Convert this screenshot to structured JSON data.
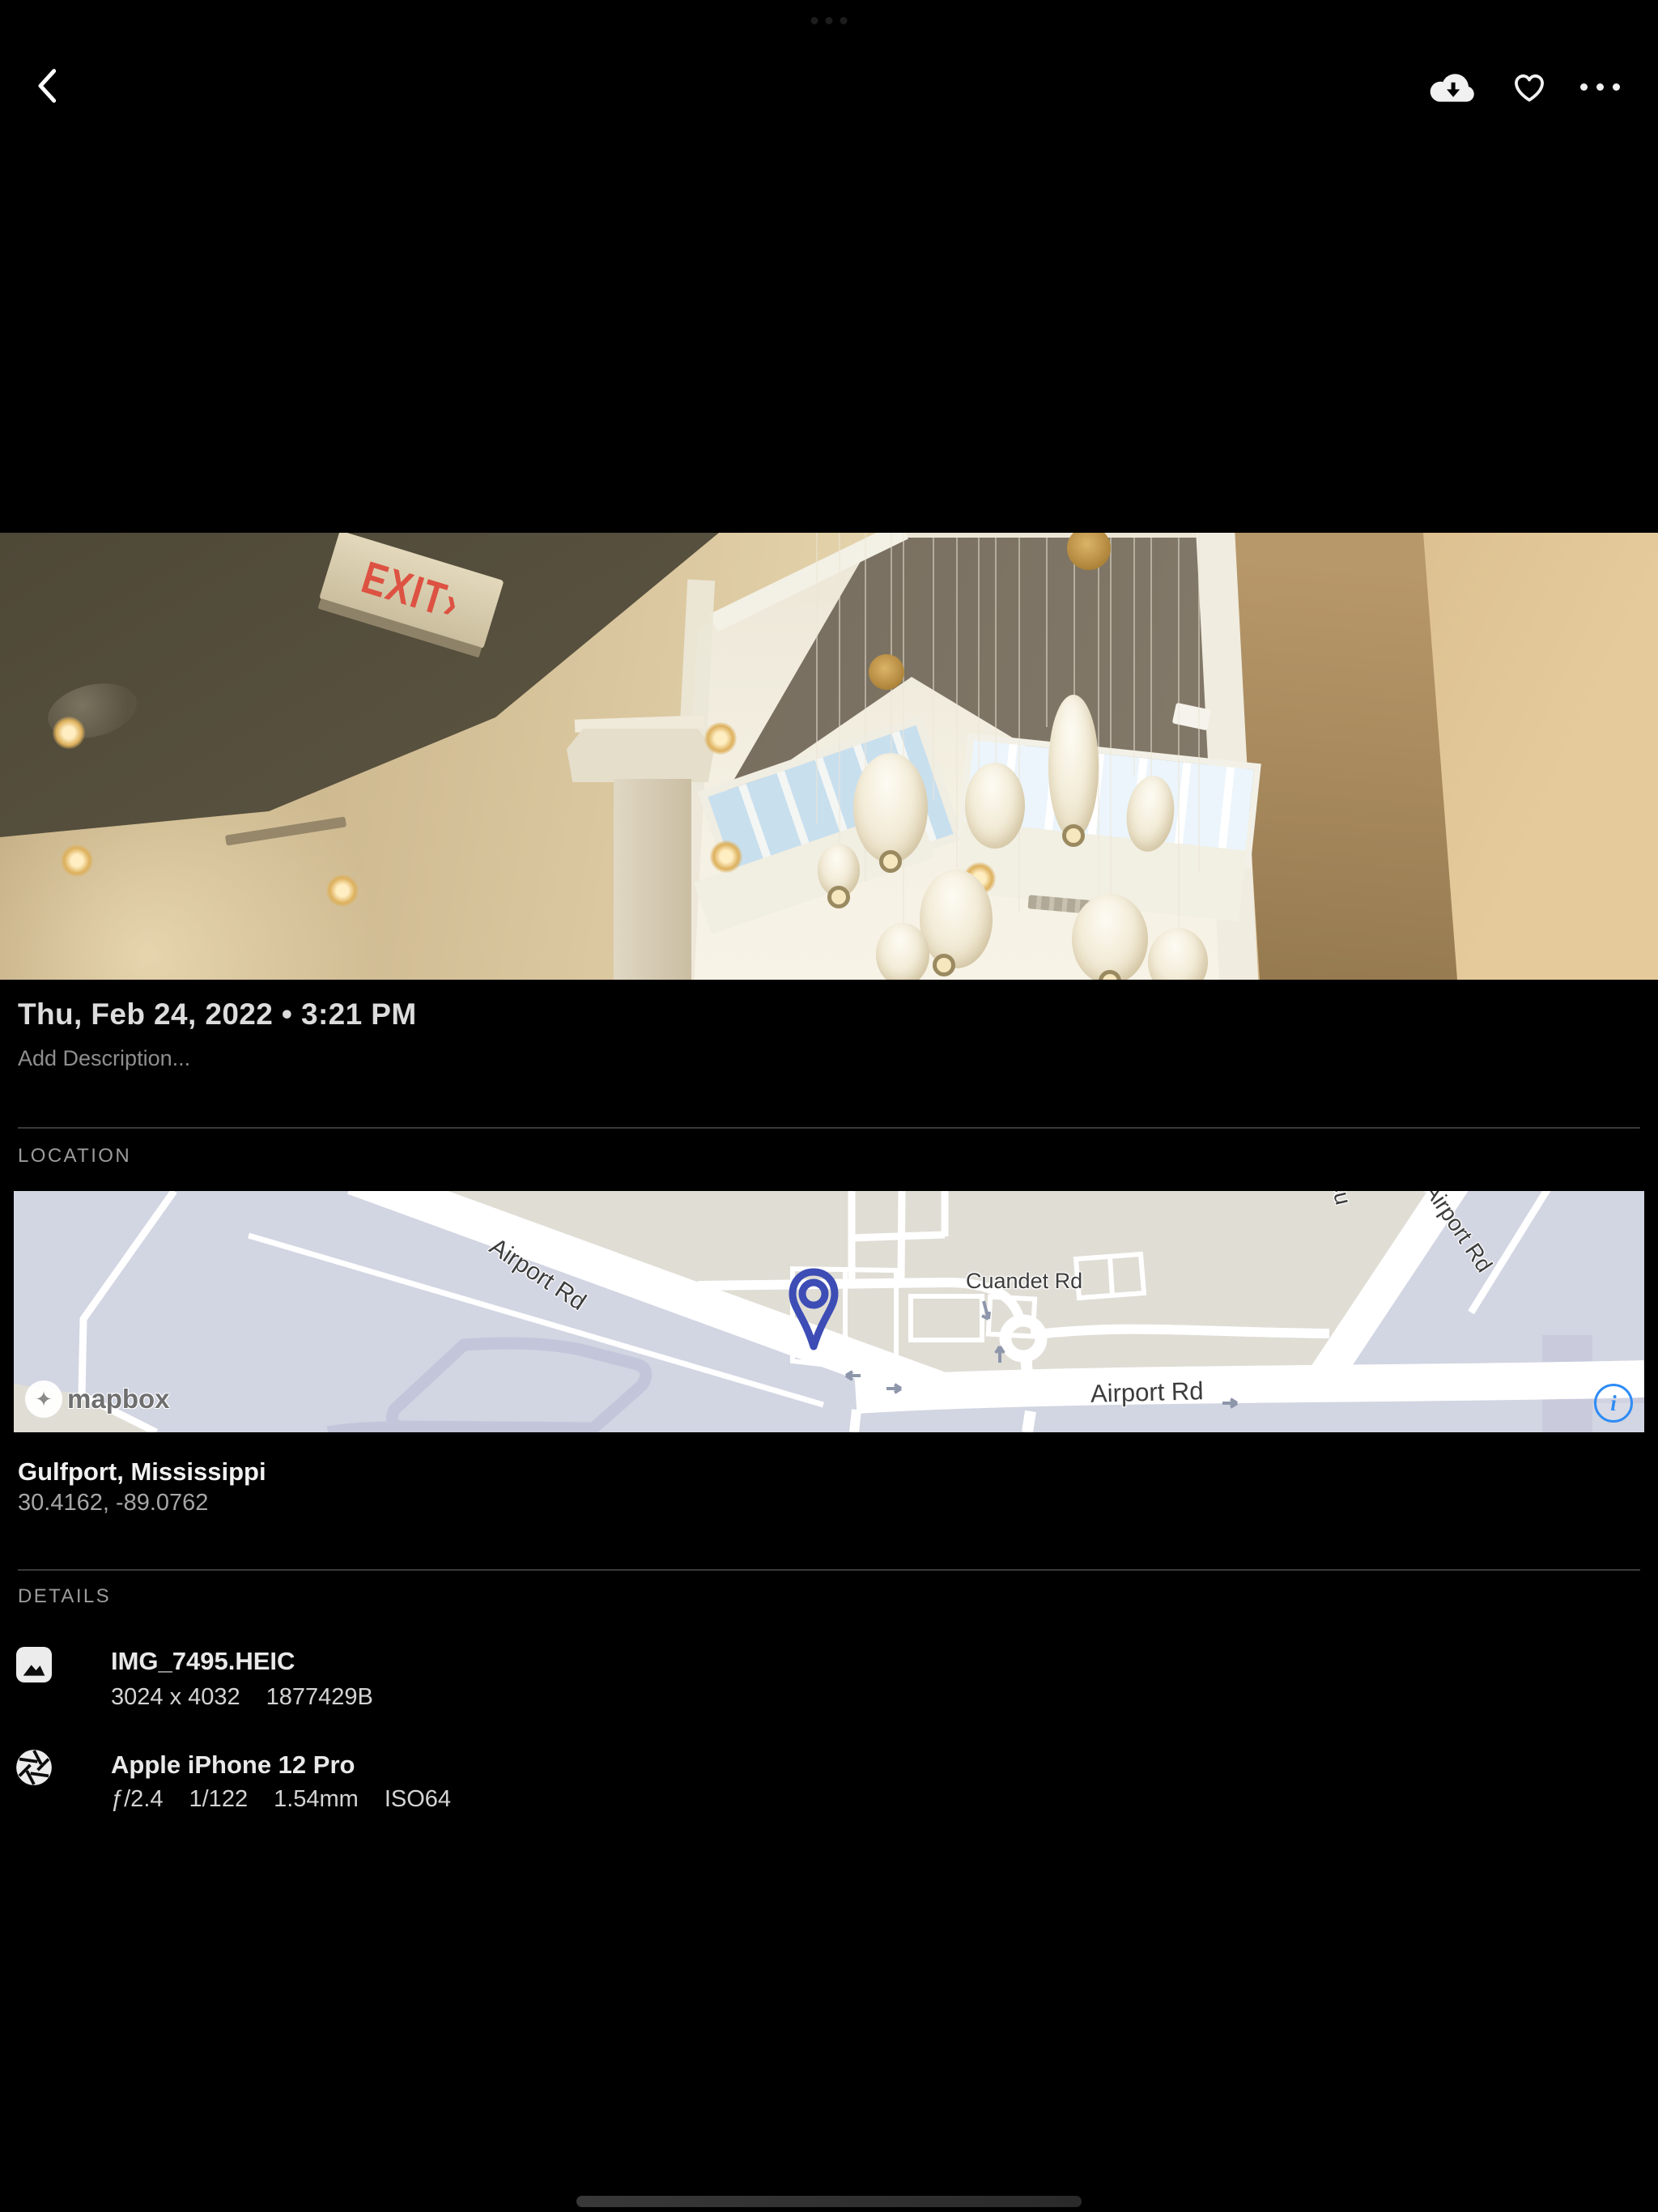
{
  "header": {
    "icons": [
      {
        "name": "back-icon"
      },
      {
        "name": "cloud-download-icon"
      },
      {
        "name": "favorite-icon"
      },
      {
        "name": "more-icon"
      }
    ]
  },
  "photo": {
    "datetime": "Thu, Feb 24, 2022 • 3:21 PM",
    "description_placeholder": "Add Description...",
    "exit_sign": "EXIT›"
  },
  "location": {
    "label": "LOCATION",
    "place": "Gulfport, Mississippi",
    "coordinates": "30.4162, -89.0762",
    "map": {
      "attribution": "mapbox",
      "attribution_glyph": "✦",
      "info": "i",
      "labels": {
        "airport_rd_nw": "Airport Rd",
        "airport_rd_south": "Airport Rd",
        "airport_rd_ne": "Airport Rd",
        "cuandet_rd": "Cuandet Rd",
        "partial_road": "Cu"
      }
    }
  },
  "details": {
    "label": "DETAILS",
    "file": {
      "name": "IMG_7495.HEIC",
      "dimensions": "3024 x 4032",
      "size": "1877429B"
    },
    "camera": {
      "name": "Apple iPhone 12 Pro",
      "specs": [
        "ƒ/2.4",
        "1/122",
        "1.54mm",
        "ISO64"
      ]
    }
  },
  "colors": {
    "background": "#000000",
    "primary_text": "#e9e9e9",
    "secondary_text": "#9c9c9c",
    "exit_red": "#dd5242",
    "pin_indigo": "#3d4db5",
    "info_blue": "#2e8cf5",
    "map_land": "#e0ddd5",
    "map_water": "#d2d5e2",
    "map_road": "#ffffff"
  }
}
